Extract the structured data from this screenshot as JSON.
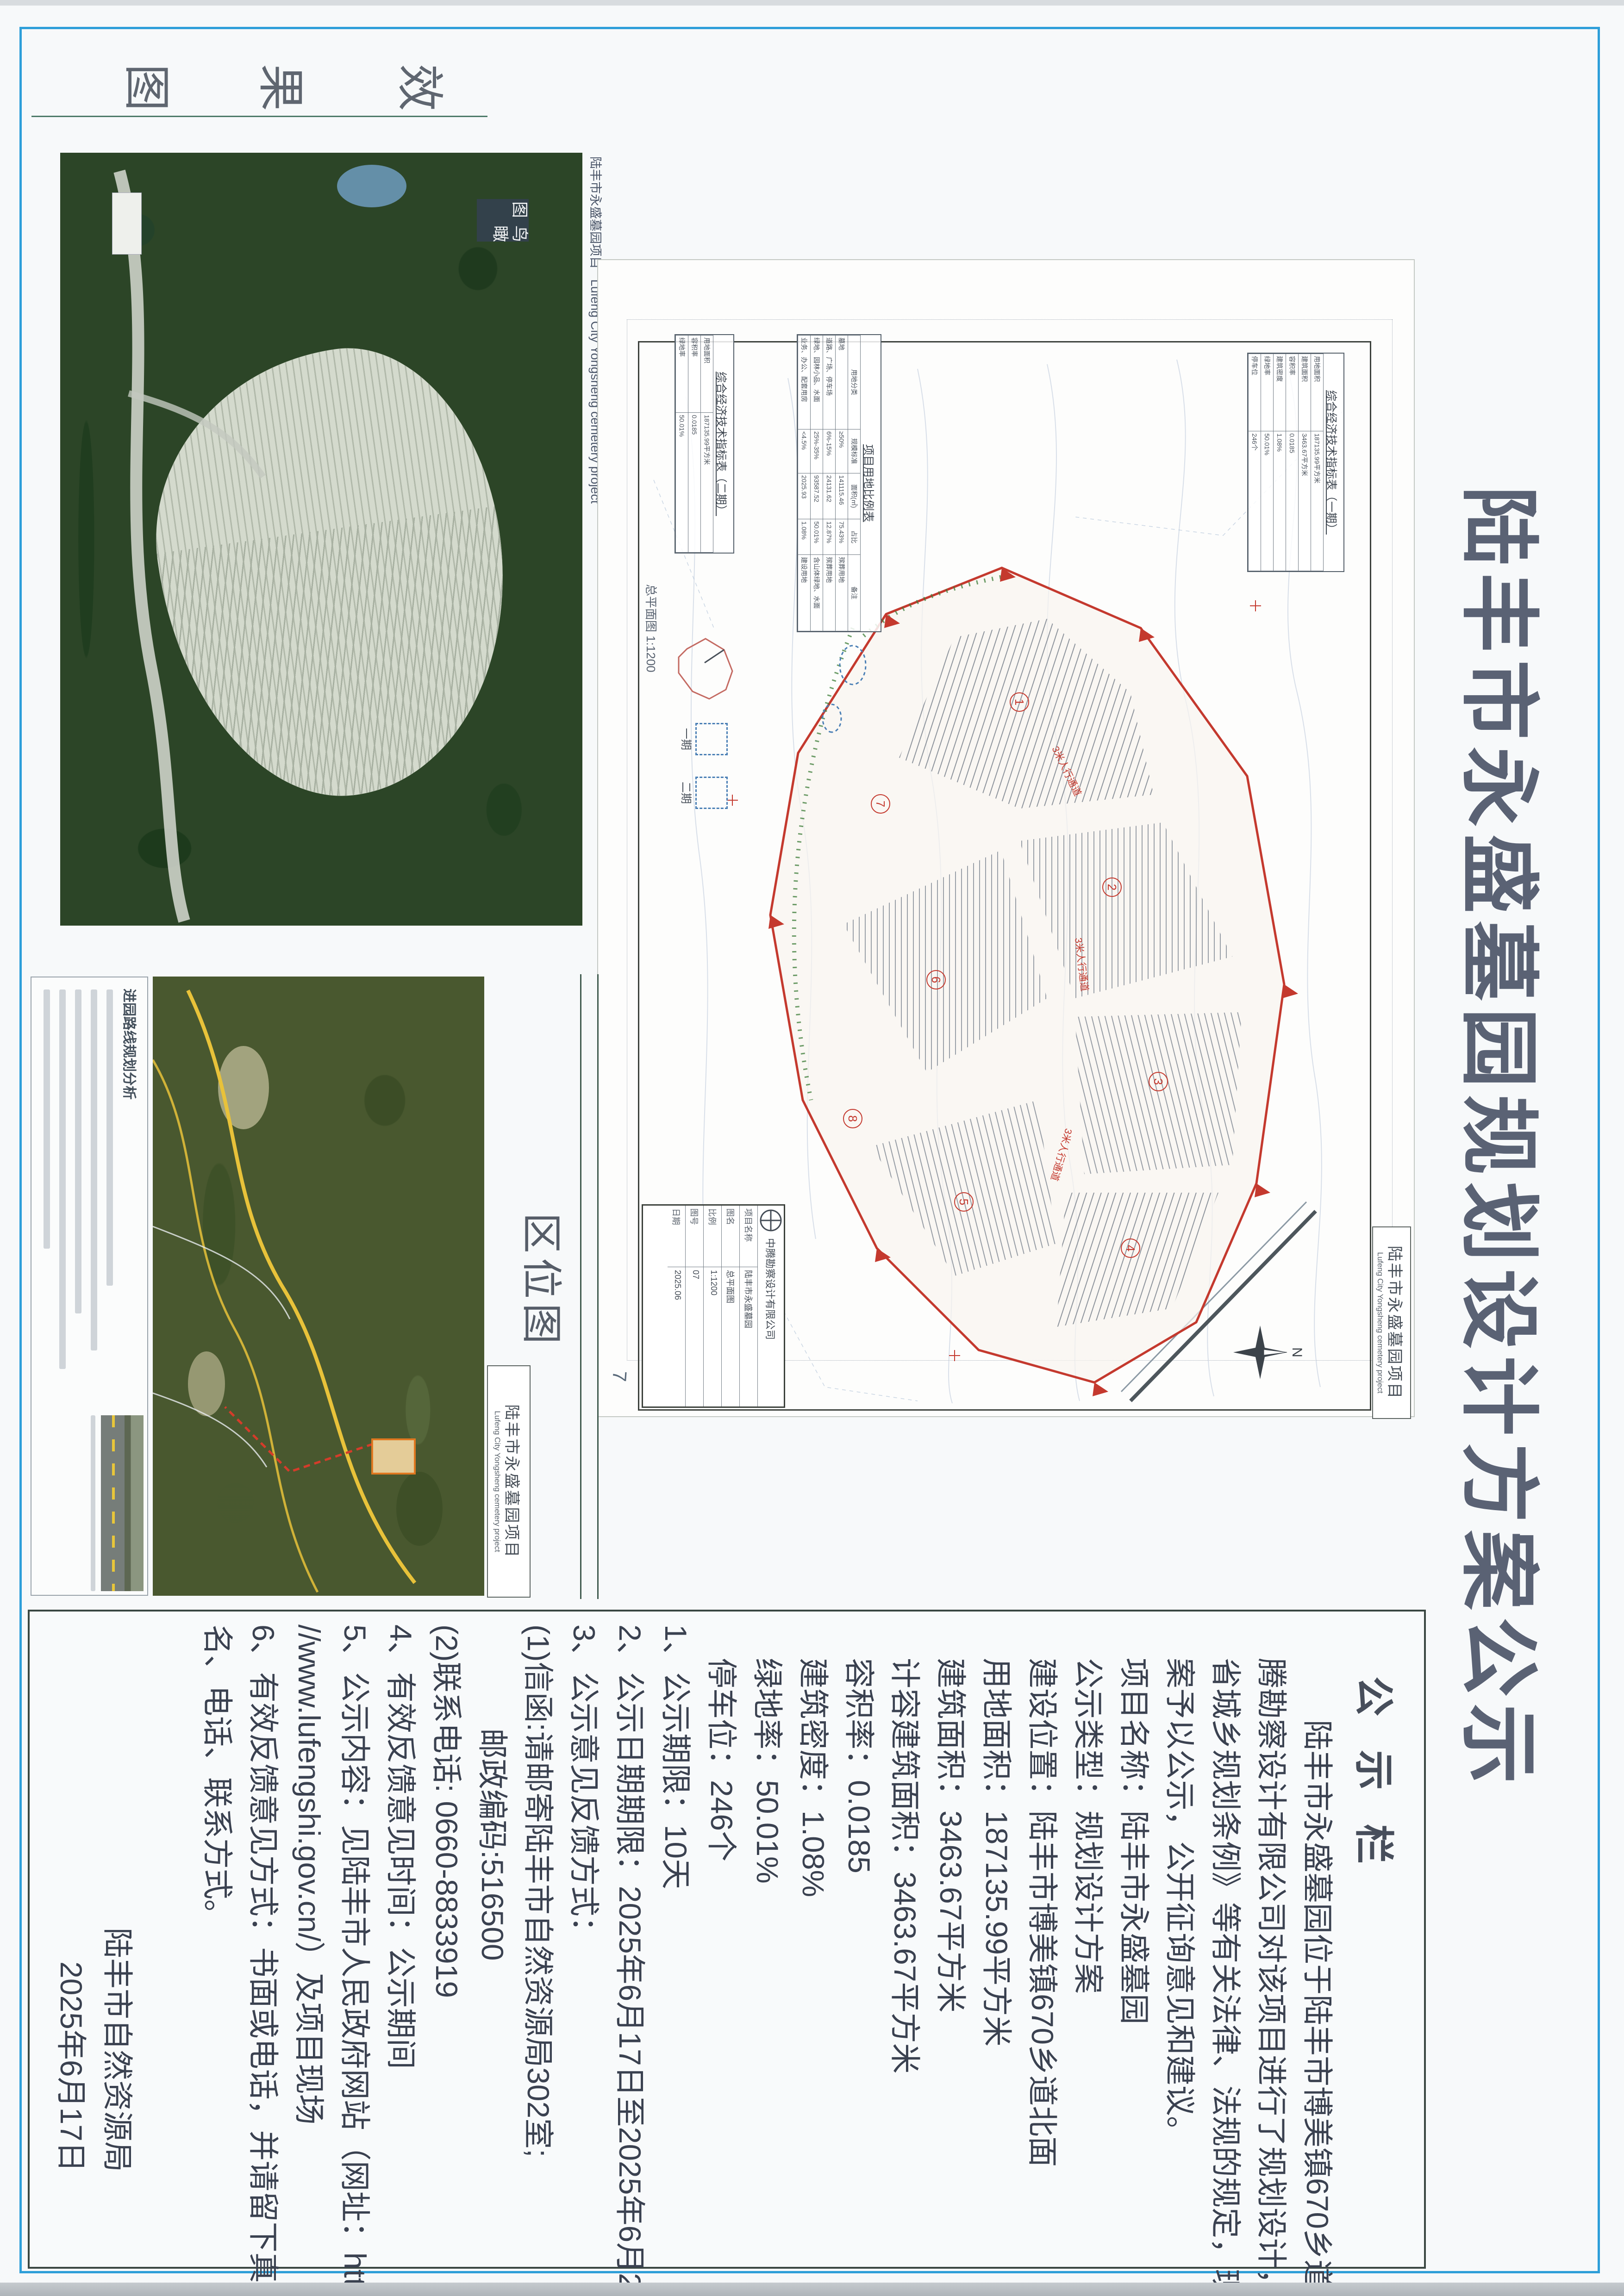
{
  "doc_title": "陆丰市永盛墓园规划设计方案公示",
  "sections": {
    "render": {
      "label_chars": [
        "效",
        "果",
        "图"
      ],
      "badge": "鸟瞰图",
      "caption_cn": "陆丰市永盛墓园项目",
      "caption_en": "Lufeng City Yongsheng cemetery project"
    },
    "location": {
      "label": "区位图",
      "caption_cn": "陆丰市永盛墓园项目",
      "caption_en": "Lufeng City Yongsheng cemetery project",
      "panel_title": "进园路线规划分析"
    },
    "plan": {
      "caption_cn": "陆丰市永盛墓园项目",
      "caption_en": "Lufeng City Yongsheng cemetery project",
      "compass_n": "N",
      "page_no": "7",
      "scale_note": "总平面图 1:1200",
      "path_label_1": "3米人行通道",
      "path_label_2": "3米人行通道",
      "path_label_3": "3米人行通道",
      "zones": [
        "1",
        "2",
        "3",
        "4",
        "5",
        "6",
        "7",
        "8"
      ],
      "legend": {
        "phase1": "一期",
        "phase2": "二期"
      },
      "tables": {
        "econ1_title": "综合经济技术指标表（一期）",
        "econ2_title": "综合经济技术指标表（二期）",
        "econ_rows": [
          [
            "用地面积",
            "187135.99平方米"
          ],
          [
            "建筑面积",
            "3463.67平方米"
          ],
          [
            "容积率",
            "0.0185"
          ],
          [
            "建筑密度",
            "1.08%"
          ],
          [
            "绿地率",
            "50.01%"
          ],
          [
            "停车位",
            "246个"
          ]
        ],
        "land_title": "项目用地比例表",
        "land_headers": [
          "用地分类",
          "规模标准",
          "面积(㎡)",
          "占比",
          "备注"
        ],
        "land_rows": [
          [
            "墓地",
            "≥50%",
            "141115.46",
            "75.43%",
            "殡葬用地"
          ],
          [
            "道路、广场、停车场",
            "6%-15%",
            "24131.62",
            "12.87%",
            "殡葬用地"
          ],
          [
            "绿地、园林小品、水面",
            "25%-35%",
            "93587.52",
            "50.01%",
            "含山体绿地、水面"
          ],
          [
            "业务、办公、配套用房",
            "<4.5%",
            "2025.93",
            "1.08%",
            "建设用地"
          ]
        ]
      },
      "titleblock": {
        "company": "中腾勘察设计有限公司",
        "fields": [
          [
            "项目名称",
            "陆丰市永盛墓园"
          ],
          [
            "图名",
            "总平面图"
          ],
          [
            "比例",
            "1:1200"
          ],
          [
            "图号",
            "07"
          ],
          [
            "日期",
            "2025.06"
          ]
        ]
      }
    }
  },
  "notice": {
    "header": "公 示 栏",
    "lines": [
      "陆丰市永盛墓园位于陆丰市博美镇670乡道北面，中",
      "腾勘察设计有限公司对该项目进行了规划设计，根据《广东",
      "省城乡规划条例》等有关法律、法规的规定，现将本设计方",
      "案予以公示，公开征询意见和建议。",
      "项目名称：陆丰市永盛墓园",
      "公示类型：规划设计方案",
      "建设位置：陆丰市博美镇670乡道北面",
      "用地面积：187135.99平方米",
      "建筑面积：3463.67平方米",
      "计容建筑面积：3463.67平方米",
      "容积率：0.0185",
      "建筑密度：1.08%",
      "绿地率：50.01%",
      "停车位：246个",
      "1、公示期限：10天",
      "2、公示日期期限：2025年6月17日至2025年6月26日",
      "3、公示意见反馈方式：",
      "(1)信函:请邮寄陆丰市自然资源局302室;",
      "邮政编码:516500",
      "(2)联系电话: 0660-8833919",
      "4、有效反馈意见时间：公示期间",
      "5、公示内容：见陆丰市人民政府网站（网址：http:",
      "//www.lufengshi.gov.cn/）及项目现场",
      "6、有效反馈意见方式：书面或电话，并请留下真实姓",
      "名、电话、联系方式。"
    ],
    "signature": [
      "陆丰市自然资源局",
      "2025年6月17日"
    ]
  }
}
